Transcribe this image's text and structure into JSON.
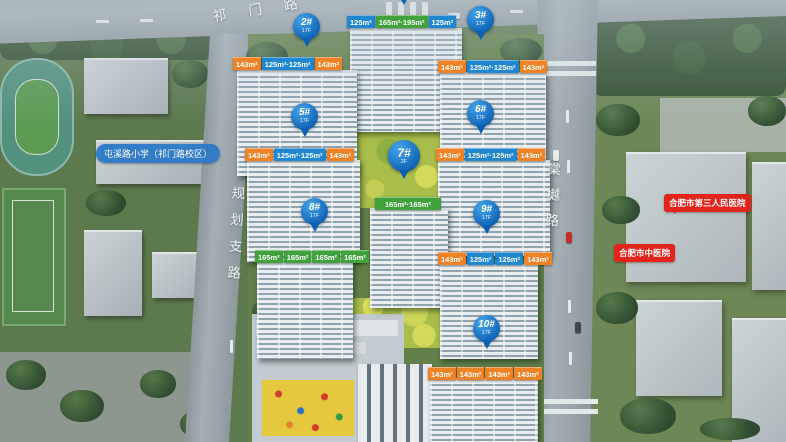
{
  "map": {
    "roads": {
      "top": "祁门路",
      "left": "规划支路",
      "right": "棠樾路"
    },
    "landmarks": {
      "school": "屯溪路小学（祁门路校区）",
      "hospital1": "合肥市第三人民医院",
      "hospital2": "合肥市中医院"
    },
    "pins": [
      {
        "label": "2#",
        "floors": "17F"
      },
      {
        "label": "3#",
        "floors": "17F"
      },
      {
        "label": "5#",
        "floors": "17F"
      },
      {
        "label": "6#",
        "floors": "17F"
      },
      {
        "label": "7#",
        "floors": "2F"
      },
      {
        "label": "8#",
        "floors": "17F"
      },
      {
        "label": "9#",
        "floors": "17F"
      },
      {
        "label": "10#",
        "floors": "17F"
      }
    ],
    "unit_rows": [
      {
        "building": "1#",
        "tags": [
          "125m²",
          "165m²·195m²",
          "125m²"
        ]
      },
      {
        "building": "2#",
        "tags": [
          "143m²",
          "125m²·125m²",
          "143m²"
        ]
      },
      {
        "building": "3#",
        "tags": [
          "143m²",
          "125m²·125m²",
          "143m²"
        ]
      },
      {
        "building": "5#",
        "tags": [
          "143m²",
          "125m²·125m²",
          "143m²"
        ]
      },
      {
        "building": "6#",
        "tags": [
          "143m²",
          "125m²·125m²",
          "143m²"
        ]
      },
      {
        "building": "7#",
        "tags": [
          "165m²·165m²"
        ]
      },
      {
        "building": "8#",
        "tags": [
          "165m²",
          "165m²",
          "165m²",
          "165m²"
        ]
      },
      {
        "building": "9#",
        "tags": [
          "143m²",
          "125m²",
          "125m²",
          "143m²"
        ]
      },
      {
        "building": "10#",
        "tags": [
          "143m²",
          "143m²",
          "143m²",
          "143m²"
        ]
      }
    ],
    "colors": {
      "pin_blue": "#1878c8",
      "tag_orange": "#ef8224",
      "tag_blue": "#1f86d0",
      "tag_green": "#3fa23a",
      "bubble_red": "#e2241d",
      "school_blue": "#2c78c6"
    }
  }
}
